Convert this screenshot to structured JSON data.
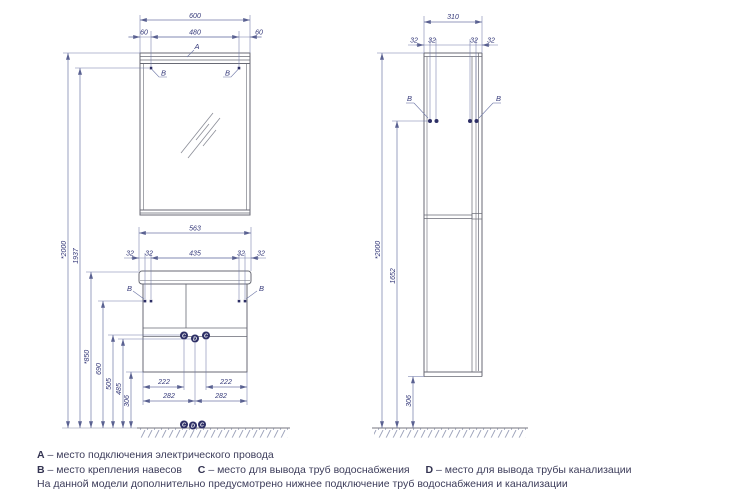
{
  "title": "Furniture mounting scheme (mirror cabinet, vanity and tall cabinet)",
  "colors": {
    "object_line": "#686a74",
    "dim_line": "#7079a8",
    "dim_text": "#343879",
    "point_fill": "#2d2f66",
    "legend_text": "#3c3c5a"
  },
  "left_view": {
    "top_width": "600",
    "side_offset": "60",
    "mount_span": "480",
    "label_a": "A",
    "label_b": "B",
    "height_total": "*2000",
    "height_mount_row": "1937",
    "counter_width": "563",
    "off32": "32",
    "vanity_mount_span": "435",
    "height_counter": "*850",
    "height_hangers": "690",
    "height_water": "505",
    "height_drain": "485",
    "height_bottom": "306",
    "water_offset": "222",
    "drain_offset": "282",
    "point_c": "C",
    "point_d": "D"
  },
  "right_view": {
    "depth": "310",
    "off32": "32",
    "label_b": "B",
    "height_total": "*2000",
    "height_body": "1652",
    "height_bottom": "306"
  },
  "legend": {
    "items": [
      {
        "key": "A",
        "text": "– место подключения электрического провода"
      },
      {
        "key": "B",
        "text": "– место крепления навесов"
      },
      {
        "key": "C",
        "text": "– место для вывода труб водоснабжения"
      },
      {
        "key": "D",
        "text": "– место для вывода трубы канализации"
      }
    ],
    "note": "На данной модели дополнительно предусмотрено нижнее подключение труб водоснабжения и канализации"
  }
}
